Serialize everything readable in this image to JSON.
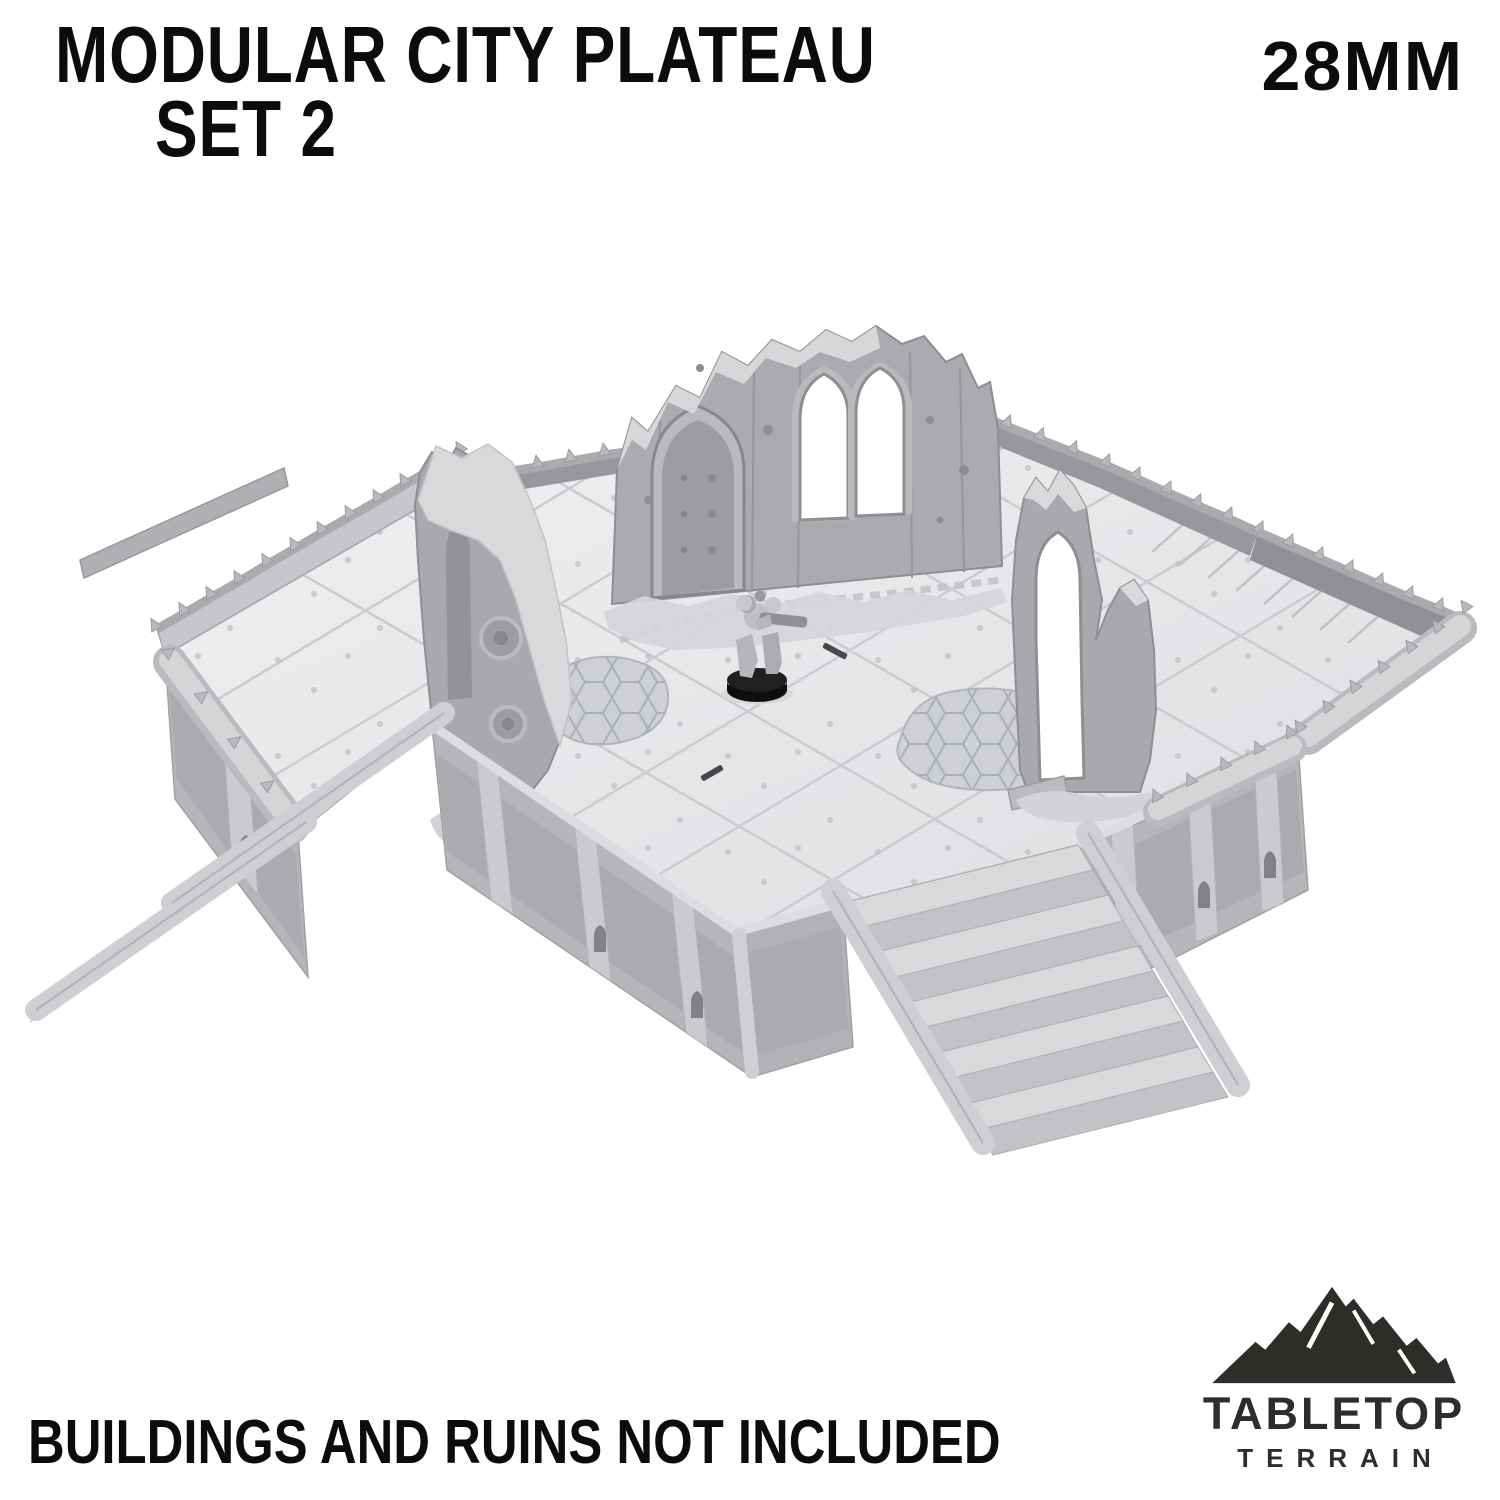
{
  "header": {
    "title_line1": "MODULAR CITY PLATEAU",
    "title_line2": "SET 2",
    "scale_badge": "28MM"
  },
  "footer": {
    "disclaimer": "BUILDINGS AND RUINS NOT INCLUDED"
  },
  "brand": {
    "wordmark_top": "TABLETOP",
    "wordmark_bottom": "TERRAIN",
    "logo_icon": "mountain-icon",
    "logo_color": "#2f2d2a"
  },
  "render": {
    "subject": "3D render of a modular sci-fi city plateau terrain piece shown with a 28mm space marine miniature for scale",
    "background": "#ffffff",
    "palette": {
      "floor_light": "#e9e9eb",
      "floor_seam": "#c9cacd",
      "wall_mid": "#b4b6b9",
      "wall_panel": "#a9abaf",
      "parapet_dark": "#96989c",
      "ruin_gray": "#a7a9ac",
      "rubble_light": "#d6d7d9",
      "step_tread": "#d8d9db",
      "step_riser": "#c2c3c6",
      "miniature_base": "#141417"
    },
    "elements": [
      "plateau-floor",
      "left-staircase",
      "front-staircase",
      "right-ramp-wing",
      "spiked-parapet",
      "edge-bumper-pipes",
      "front-wall-panels",
      "ruined-gothic-wall-center",
      "ruined-gothic-wall-left",
      "ruined-gothic-wall-right",
      "floor-crater-hex",
      "rubble-piles",
      "space-marine-miniature"
    ]
  }
}
